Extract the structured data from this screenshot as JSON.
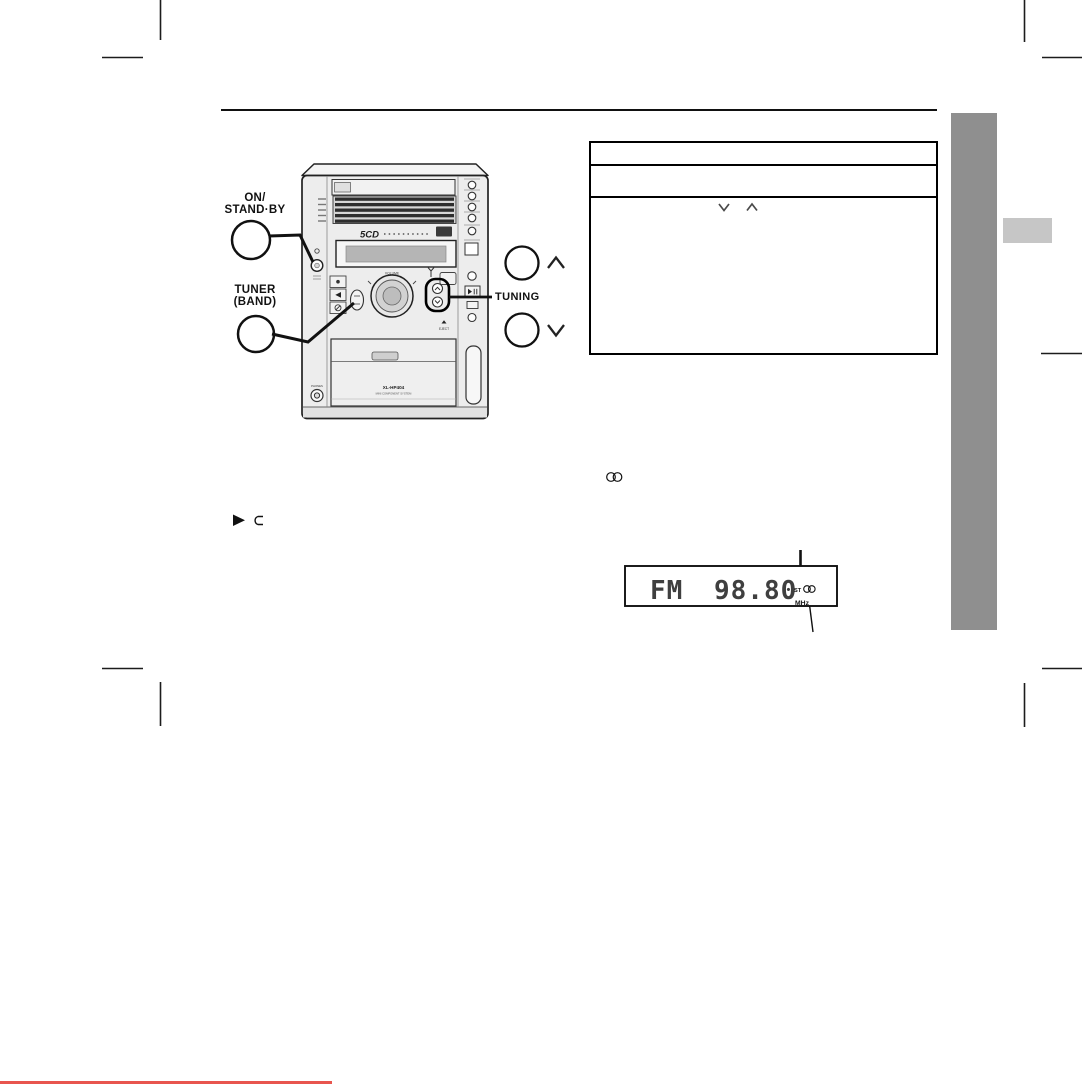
{
  "colors": {
    "ink": "#111111",
    "sidebar_gray": "#8f8f8f",
    "side_tab_gray": "#c6c6c6",
    "footer_line_red": "#e8554e",
    "display_segment_gray": "#3f3f3f"
  },
  "callouts": {
    "power": {
      "line1": "ON/",
      "line2": "STAND·BY"
    },
    "tuner_band": {
      "line1": "TUNER",
      "line2": "(BAND)"
    },
    "tuning": {
      "label": "TUNING"
    }
  },
  "front_panel": {
    "cd_logo": "5CD",
    "volume_label": "VOLUME",
    "model": "XL-HP404",
    "model_sub": "MINI COMPONENT SYSTEM",
    "phones_label": "PHONES",
    "eject_label": "EJECT"
  },
  "tuner_display": {
    "band": "FM",
    "frequency": "98.80",
    "frequency_unit": "MHz",
    "stereo_indicator": "ST"
  },
  "infobox": {
    "rows": 3
  },
  "icons": [
    "chevron-up-icon",
    "chevron-down-icon",
    "play-icon",
    "loop-icon",
    "stereo-broadcast-icon",
    "stereo-display-icon",
    "power-button",
    "volume-knob",
    "phones-jack",
    "eject-arrow-icon"
  ]
}
